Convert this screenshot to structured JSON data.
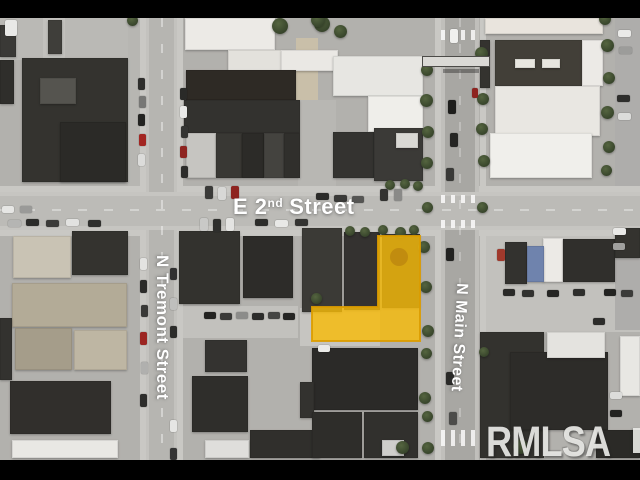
{
  "image": {
    "width": 640,
    "height": 480,
    "letterbox_color": "#000000"
  },
  "watermark": {
    "text": "RMLSA"
  },
  "streets": {
    "e2nd": {
      "prefix": "E 2",
      "sup": "nd",
      "suffix": "Street",
      "full": "E 2nd Street"
    },
    "tremont": {
      "label": "N Tremont Street"
    },
    "main": {
      "label": "N Main Street"
    }
  },
  "parcel": {
    "points": "312,307 378,307 378,236 420,236 420,341 312,341",
    "fill": "rgba(246,187,10,0.82)",
    "stroke": "rgba(220,156,0,0.9)",
    "vent": {
      "cx": "399",
      "cy": "257",
      "r": "9",
      "fill": "rgba(176,122,14,0.55)"
    }
  },
  "scene": {
    "lots": [
      [
        0,
        18,
        146,
        42,
        "#bab9b5"
      ],
      [
        43,
        18,
        22,
        102,
        "#c2c1bd"
      ],
      [
        296,
        38,
        22,
        64,
        "#c9bfa9"
      ],
      [
        298,
        100,
        38,
        92,
        "#b8b7b3"
      ],
      [
        480,
        218,
        160,
        114,
        "#c2c1bd"
      ],
      [
        182,
        306,
        116,
        32,
        "#c2c1bd"
      ],
      [
        300,
        308,
        80,
        38,
        "#c6c5c1"
      ],
      [
        615,
        18,
        25,
        312,
        "#aeadab"
      ],
      [
        128,
        18,
        18,
        174,
        "#b7b6b2"
      ]
    ],
    "sidewalks": [
      [
        0,
        186,
        640,
        6
      ],
      [
        0,
        230,
        640,
        6
      ],
      [
        140,
        18,
        6,
        442
      ],
      [
        177,
        18,
        6,
        442
      ],
      [
        435,
        18,
        6,
        442
      ],
      [
        480,
        18,
        6,
        442
      ]
    ],
    "buildings": [
      [
        0,
        25,
        16,
        32,
        "#3a3936"
      ],
      [
        48,
        20,
        14,
        34,
        "#3f3e3a"
      ],
      [
        0,
        60,
        14,
        44,
        "#2f2e2b"
      ],
      [
        22,
        58,
        106,
        124,
        "#34332f"
      ],
      [
        60,
        122,
        66,
        60,
        "#2b2a27"
      ],
      [
        40,
        78,
        36,
        26,
        "#55544f"
      ],
      [
        185,
        18,
        90,
        32,
        "#eceae6"
      ],
      [
        228,
        50,
        65,
        21,
        "#e3e1dc"
      ],
      [
        281,
        50,
        57,
        21,
        "#eae8e4"
      ],
      [
        186,
        70,
        110,
        30,
        "#2e2a25"
      ],
      [
        184,
        100,
        116,
        33,
        "#33322f"
      ],
      [
        186,
        133,
        30,
        45,
        "#c6c5c1"
      ],
      [
        216,
        133,
        26,
        45,
        "#393834"
      ],
      [
        242,
        133,
        22,
        45,
        "#2c2b28"
      ],
      [
        264,
        133,
        20,
        45,
        "#44433f"
      ],
      [
        284,
        133,
        16,
        45,
        "#302f2c"
      ],
      [
        333,
        56,
        90,
        40,
        "#e7e6e2"
      ],
      [
        368,
        96,
        55,
        36,
        "#efeeea"
      ],
      [
        333,
        132,
        41,
        46,
        "#343330"
      ],
      [
        374,
        128,
        49,
        53,
        "#3b3a37"
      ],
      [
        396,
        133,
        22,
        15,
        "#d9d8d4"
      ],
      [
        485,
        18,
        118,
        16,
        "#e9e4dd"
      ],
      [
        480,
        40,
        10,
        48,
        "#34332f"
      ],
      [
        495,
        40,
        88,
        46,
        "#423f38"
      ],
      [
        515,
        59,
        20,
        9,
        "#e8e6e0"
      ],
      [
        542,
        59,
        18,
        9,
        "#e8e6e0"
      ],
      [
        582,
        40,
        21,
        46,
        "#eceae6"
      ],
      [
        495,
        86,
        105,
        50,
        "#e9e7e2"
      ],
      [
        490,
        133,
        102,
        45,
        "#f0efeb"
      ],
      [
        13,
        236,
        58,
        42,
        "#c9c3b4"
      ],
      [
        72,
        231,
        56,
        44,
        "#34332f"
      ],
      [
        12,
        283,
        115,
        44,
        "#b3ab97"
      ],
      [
        15,
        328,
        57,
        42,
        "#a59d8a"
      ],
      [
        74,
        330,
        53,
        40,
        "#beb6a3"
      ],
      [
        0,
        318,
        12,
        62,
        "#33322f"
      ],
      [
        10,
        381,
        101,
        53,
        "#312f2c"
      ],
      [
        12,
        440,
        106,
        18,
        "#e9e8e4"
      ],
      [
        179,
        231,
        61,
        73,
        "#33322e"
      ],
      [
        243,
        236,
        50,
        62,
        "#2d2c29"
      ],
      [
        205,
        340,
        42,
        32,
        "#343330"
      ],
      [
        192,
        376,
        56,
        56,
        "#2f2e2b"
      ],
      [
        250,
        430,
        70,
        28,
        "#302f2c"
      ],
      [
        205,
        440,
        44,
        18,
        "#dfdedb"
      ],
      [
        302,
        228,
        40,
        84,
        "#3b3a36"
      ],
      [
        344,
        232,
        36,
        78,
        "#343230"
      ],
      [
        382,
        234,
        38,
        74,
        "#3a3835"
      ],
      [
        312,
        348,
        106,
        62,
        "#2b2a28"
      ],
      [
        300,
        382,
        14,
        36,
        "#33322f"
      ],
      [
        312,
        412,
        50,
        46,
        "#2e2d2a"
      ],
      [
        364,
        412,
        54,
        46,
        "#31302d"
      ],
      [
        382,
        440,
        22,
        16,
        "#cfcecb"
      ],
      [
        505,
        242,
        22,
        42,
        "#33322f"
      ],
      [
        543,
        238,
        20,
        44,
        "#eceae6"
      ],
      [
        527,
        246,
        17,
        36,
        "#6f83ad"
      ],
      [
        563,
        239,
        52,
        43,
        "#302f2c"
      ],
      [
        615,
        228,
        25,
        30,
        "#34332f"
      ],
      [
        480,
        332,
        64,
        126,
        "#33322e"
      ],
      [
        510,
        352,
        98,
        78,
        "#2d2c29"
      ],
      [
        547,
        332,
        58,
        26,
        "#e4e3df"
      ],
      [
        620,
        336,
        20,
        60,
        "#e8e7e3"
      ],
      [
        596,
        430,
        44,
        28,
        "#2b2a27"
      ]
    ],
    "trees": [
      [
        322,
        24,
        16
      ],
      [
        340,
        31,
        13
      ],
      [
        280,
        26,
        16
      ],
      [
        318,
        20,
        14
      ],
      [
        132,
        20,
        11
      ],
      [
        427,
        70,
        12
      ],
      [
        426,
        100,
        13
      ],
      [
        428,
        132,
        12
      ],
      [
        427,
        163,
        12
      ],
      [
        427,
        207,
        11
      ],
      [
        481,
        53,
        13
      ],
      [
        483,
        99,
        12
      ],
      [
        482,
        129,
        12
      ],
      [
        484,
        161,
        12
      ],
      [
        482,
        207,
        11
      ],
      [
        605,
        19,
        12
      ],
      [
        607,
        45,
        13
      ],
      [
        609,
        78,
        12
      ],
      [
        607,
        112,
        13
      ],
      [
        609,
        147,
        12
      ],
      [
        606,
        170,
        11
      ],
      [
        350,
        231,
        10
      ],
      [
        365,
        232,
        10
      ],
      [
        383,
        230,
        10
      ],
      [
        400,
        232,
        11
      ],
      [
        414,
        230,
        10
      ],
      [
        390,
        185,
        10
      ],
      [
        405,
        184,
        10
      ],
      [
        418,
        186,
        10
      ],
      [
        424,
        247,
        12
      ],
      [
        426,
        287,
        12
      ],
      [
        428,
        331,
        12
      ],
      [
        426,
        353,
        11
      ],
      [
        425,
        398,
        12
      ],
      [
        427,
        416,
        11
      ],
      [
        428,
        448,
        12
      ],
      [
        316,
        298,
        11
      ],
      [
        402,
        447,
        13
      ],
      [
        520,
        446,
        15
      ],
      [
        484,
        352,
        10
      ]
    ],
    "cars": [
      [
        205,
        186,
        8,
        13,
        "#3a3a38"
      ],
      [
        218,
        187,
        8,
        13,
        "#d8d8d6"
      ],
      [
        231,
        186,
        8,
        13,
        "#8e2420"
      ],
      [
        380,
        189,
        8,
        12,
        "#333331"
      ],
      [
        394,
        189,
        8,
        12,
        "#8a8a88"
      ],
      [
        316,
        193,
        13,
        7,
        "#2b2b29"
      ],
      [
        334,
        195,
        13,
        7,
        "#3a3a38"
      ],
      [
        352,
        196,
        12,
        7,
        "#555553"
      ],
      [
        200,
        218,
        8,
        13,
        "#c9c9c7"
      ],
      [
        213,
        219,
        8,
        13,
        "#2e2e2c"
      ],
      [
        226,
        218,
        8,
        13,
        "#e4e4e2"
      ],
      [
        8,
        220,
        13,
        7,
        "#b5b5b3"
      ],
      [
        26,
        219,
        13,
        7,
        "#2b2b29"
      ],
      [
        46,
        220,
        13,
        7,
        "#3a3a38"
      ],
      [
        66,
        219,
        13,
        7,
        "#e2e2e0"
      ],
      [
        88,
        220,
        13,
        7,
        "#2f2f2d"
      ],
      [
        2,
        206,
        12,
        7,
        "#e6e6e4"
      ],
      [
        20,
        206,
        12,
        7,
        "#9a9a98"
      ],
      [
        255,
        219,
        13,
        7,
        "#2c2c2a"
      ],
      [
        275,
        220,
        13,
        7,
        "#e8e8e6"
      ],
      [
        295,
        219,
        13,
        7,
        "#333331"
      ],
      [
        138,
        78,
        7,
        12,
        "#2e2e2c"
      ],
      [
        139,
        96,
        7,
        12,
        "#777775"
      ],
      [
        138,
        114,
        7,
        12,
        "#232321"
      ],
      [
        139,
        134,
        7,
        12,
        "#a32622"
      ],
      [
        138,
        154,
        7,
        12,
        "#dcdcda"
      ],
      [
        180,
        88,
        7,
        12,
        "#2a2a28"
      ],
      [
        180,
        106,
        7,
        12,
        "#e9e9e7"
      ],
      [
        181,
        126,
        7,
        12,
        "#343432"
      ],
      [
        180,
        146,
        7,
        12,
        "#8e2420"
      ],
      [
        181,
        166,
        7,
        12,
        "#2d2d2b"
      ],
      [
        140,
        258,
        7,
        12,
        "#e3e3e1"
      ],
      [
        140,
        280,
        7,
        13,
        "#2b2b29"
      ],
      [
        141,
        305,
        7,
        12,
        "#393937"
      ],
      [
        140,
        332,
        7,
        13,
        "#9c2521"
      ],
      [
        141,
        362,
        7,
        12,
        "#b0b0ae"
      ],
      [
        140,
        394,
        7,
        13,
        "#2e2e2c"
      ],
      [
        170,
        268,
        7,
        12,
        "#303030"
      ],
      [
        170,
        298,
        7,
        12,
        "#bfbfbd"
      ],
      [
        170,
        326,
        7,
        12,
        "#2c2c2a"
      ],
      [
        170,
        420,
        7,
        12,
        "#e6e6e4"
      ],
      [
        170,
        448,
        7,
        12,
        "#343434"
      ],
      [
        450,
        29,
        8,
        14,
        "#f0f0ee"
      ],
      [
        448,
        100,
        8,
        14,
        "#1e1e1c"
      ],
      [
        450,
        133,
        8,
        14,
        "#262624"
      ],
      [
        446,
        168,
        8,
        13,
        "#393937"
      ],
      [
        472,
        88,
        6,
        10,
        "#8e2420"
      ],
      [
        446,
        248,
        8,
        13,
        "#232321"
      ],
      [
        446,
        372,
        8,
        13,
        "#2a2a28"
      ],
      [
        449,
        412,
        8,
        13,
        "#4c4c4a"
      ],
      [
        497,
        249,
        8,
        12,
        "#a0392c"
      ],
      [
        503,
        289,
        12,
        7,
        "#2a2a28"
      ],
      [
        522,
        290,
        12,
        7,
        "#323230"
      ],
      [
        547,
        290,
        12,
        7,
        "#262624"
      ],
      [
        573,
        289,
        12,
        7,
        "#2e2e2c"
      ],
      [
        604,
        289,
        12,
        7,
        "#232321"
      ],
      [
        621,
        290,
        12,
        7,
        "#3b3b39"
      ],
      [
        593,
        318,
        12,
        7,
        "#2c2c2a"
      ],
      [
        618,
        30,
        13,
        7,
        "#eaeae8"
      ],
      [
        619,
        47,
        13,
        7,
        "#9c9c9a"
      ],
      [
        617,
        95,
        13,
        7,
        "#2e2e2c"
      ],
      [
        618,
        113,
        13,
        7,
        "#dcdcda"
      ],
      [
        610,
        392,
        12,
        7,
        "#dcdcda"
      ],
      [
        610,
        410,
        12,
        7,
        "#232321"
      ],
      [
        613,
        228,
        13,
        7,
        "#e9e9e7"
      ],
      [
        613,
        243,
        12,
        7,
        "#a0a09e"
      ],
      [
        5,
        20,
        12,
        16,
        "#e9e9e7"
      ],
      [
        204,
        312,
        12,
        7,
        "#232321"
      ],
      [
        220,
        313,
        12,
        7,
        "#3a3a38"
      ],
      [
        236,
        312,
        12,
        7,
        "#8c8c8a"
      ],
      [
        252,
        313,
        12,
        7,
        "#2c2c2a"
      ],
      [
        268,
        312,
        12,
        7,
        "#454543"
      ],
      [
        283,
        313,
        12,
        7,
        "#262624"
      ],
      [
        318,
        345,
        12,
        7,
        "#eaeae8"
      ]
    ]
  }
}
